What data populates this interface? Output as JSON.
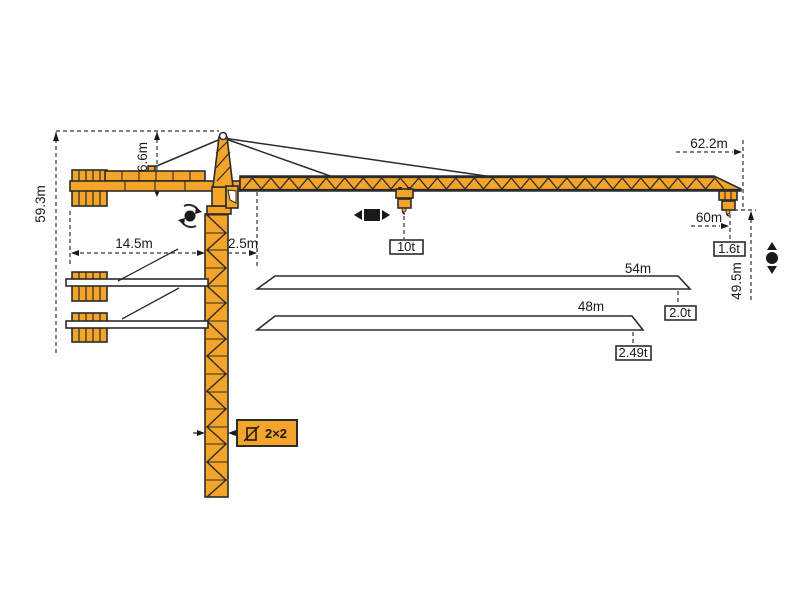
{
  "diagram": {
    "type": "tower-crane-dimension-and-load-diagram",
    "colors": {
      "crane_orange": "#F5A42A",
      "outline": "#2b2b2b",
      "dimension_lines": "#333333",
      "background": "#ffffff"
    },
    "labels": {
      "total_height": "59.3m",
      "head_height": "6.6m",
      "tail_radius": "14.5m",
      "min_radius": "2.5m",
      "tip_radius": "62.2m",
      "max_radius": "60m",
      "hook_height": "49.5m",
      "max_load": "10t",
      "tip_load_60m": "1.6t",
      "jib_option_54": "54m",
      "tip_load_54m": "2.0t",
      "jib_option_48": "48m",
      "tip_load_48m": "2.49t",
      "mast_section": "2×2"
    },
    "jib_options": [
      {
        "length": "54m",
        "tip_load": "2.0t"
      },
      {
        "length": "48m",
        "tip_load": "2.49t"
      }
    ],
    "icons": [
      "slewing-icon",
      "trolley-travel-icon",
      "hoisting-icon",
      "mast-section-icon"
    ]
  }
}
